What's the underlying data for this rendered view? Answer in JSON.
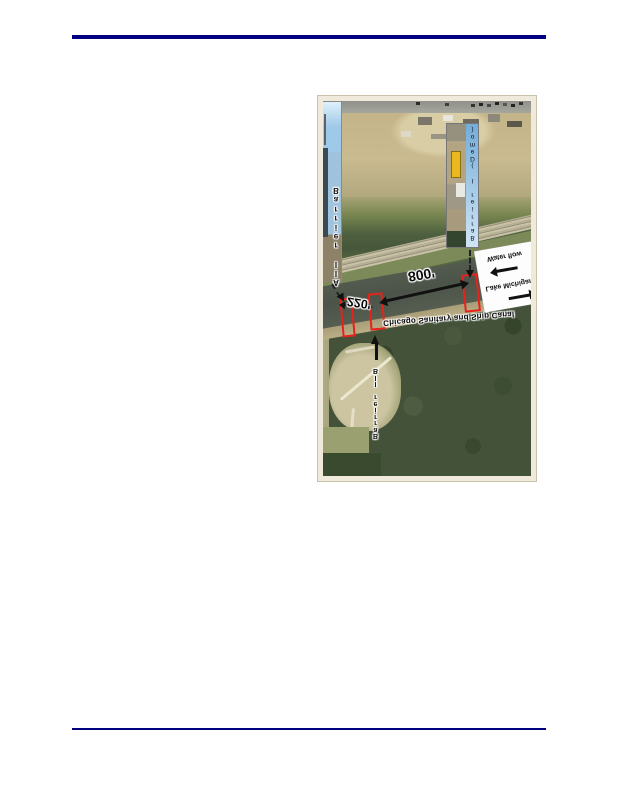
{
  "figure": {
    "labels": {
      "barrier_iia": "Barrier IIA",
      "barrier_iib": "Barrier IIB",
      "barrier_i_demo": "Barrier I (Demo)",
      "canal_name": "Chicago Sanitary and Ship Canal",
      "distance_long": "800'",
      "distance_short": "220'",
      "water_flow": "Water flow",
      "lake_michigan": "Lake Michigan"
    },
    "colors": {
      "page_rule_navy": "#000080",
      "marker_red": "#e8221b",
      "figure_mat_cream": "#efeadb",
      "water_flow_box_bg": "#fdfdfd"
    }
  }
}
